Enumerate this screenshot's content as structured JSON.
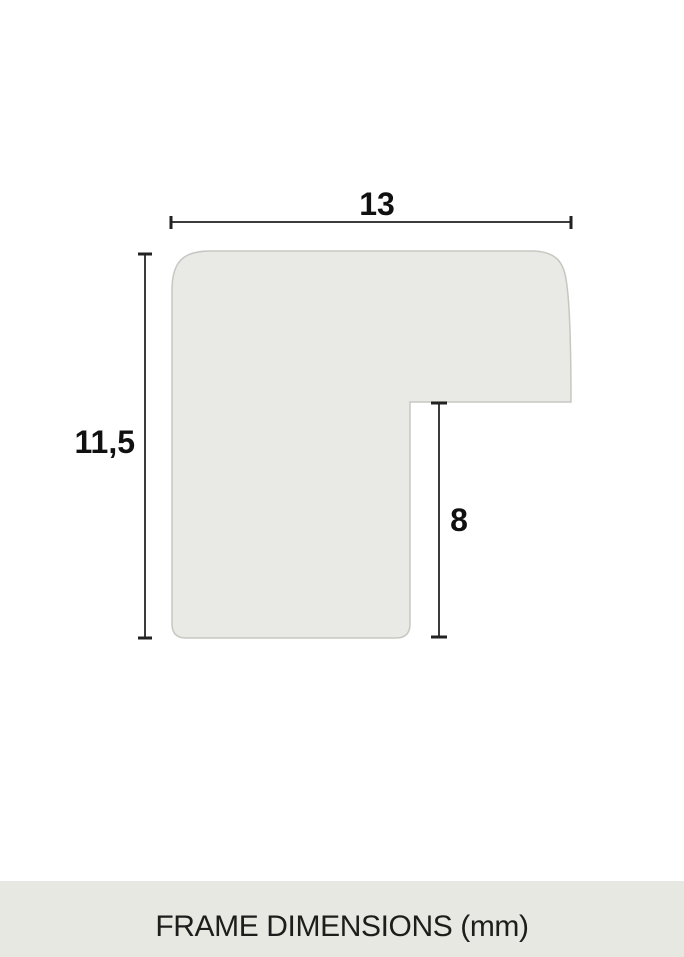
{
  "diagram": {
    "type": "frame-profile-cross-section",
    "unit": "mm",
    "colors": {
      "shape_fill": "#e9e9e5",
      "shape_stroke": "#c7c7c2",
      "dimension_line": "#3b3b3b",
      "label_text": "#111111",
      "footer_background": "#e8e8e3",
      "footer_text": "#1d1d1b",
      "page_background": "#ffffff"
    },
    "dimensions": {
      "width": {
        "label": "13",
        "value": 13
      },
      "height": {
        "label": "11,5",
        "value": 11.5
      },
      "rabbet_depth": {
        "label": "8",
        "value": 8
      }
    }
  },
  "footer": {
    "caption": "FRAME DIMENSIONS (mm)"
  }
}
